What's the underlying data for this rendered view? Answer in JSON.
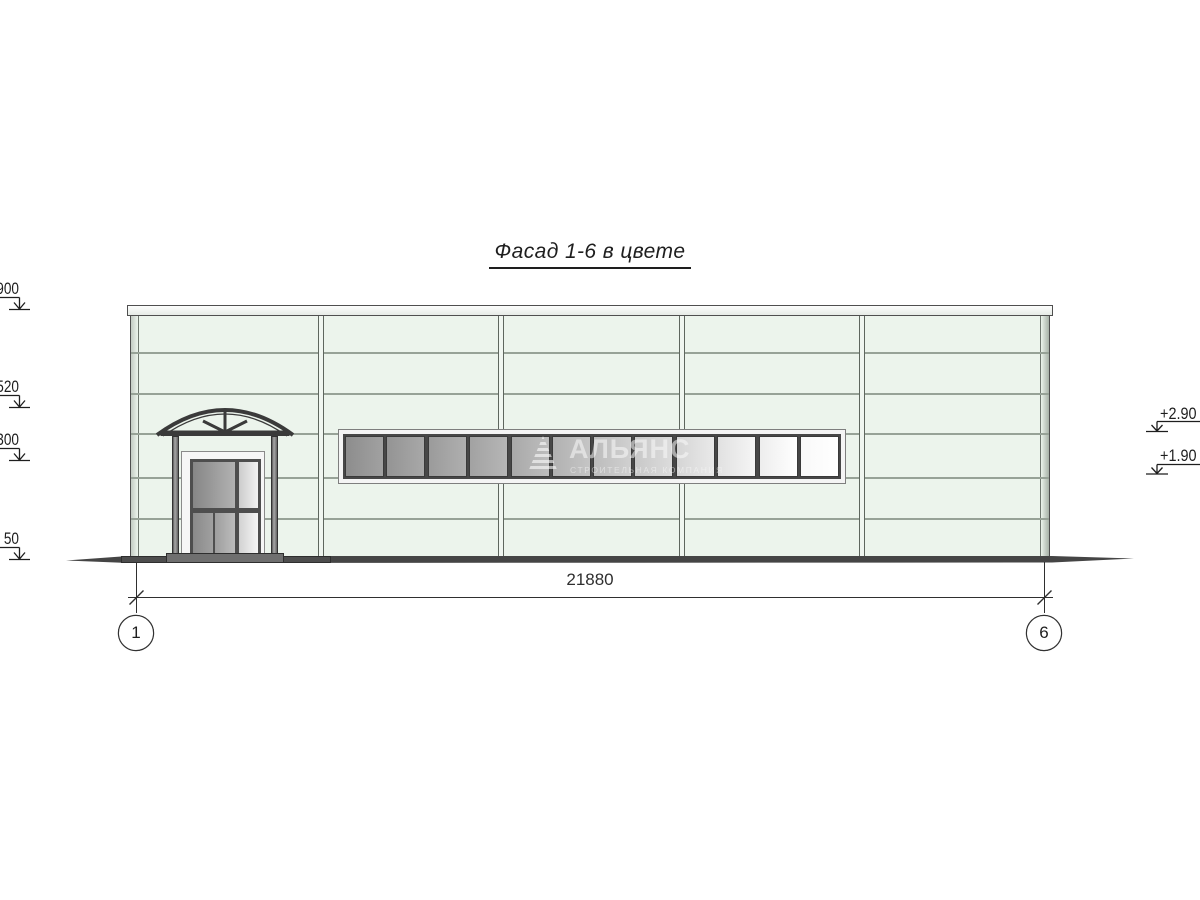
{
  "title": "Фасад 1-6 в цвете",
  "elevation_markers": {
    "left": [
      {
        "label": "900"
      },
      {
        "label": "520"
      },
      {
        "label": "300"
      },
      {
        "label": "50"
      }
    ],
    "right": [
      {
        "label": "+2.90"
      },
      {
        "label": "+1.90"
      }
    ]
  },
  "dimension": {
    "value": "21880"
  },
  "axes": [
    {
      "label": "1"
    },
    {
      "label": "6"
    }
  ],
  "watermark": {
    "name": "АЛЬЯНС",
    "tagline": "СТРОИТЕЛЬНАЯ КОМПАНИЯ"
  },
  "window_band": {
    "units": 6,
    "panes_per_unit": 2,
    "pane_colors": [
      "#8d8d8d",
      "#949494",
      "#9b9b9b",
      "#a2a2a2",
      "#a9a9a9",
      "#b1b1b1",
      "#bcbcbc",
      "#c8c8c8",
      "#d5d5d5",
      "#e1e1e1",
      "#ededed",
      "#f9f9f9"
    ]
  },
  "colors": {
    "wall_panel": "#ecf4ec",
    "panel_line": "#97a297",
    "window_frame_outer": "#f4f4f4",
    "window_frame_inner": "#474747",
    "structure_dark": "#3a3a3a",
    "ground": "#454545",
    "dimension": "#2f2f2f"
  }
}
